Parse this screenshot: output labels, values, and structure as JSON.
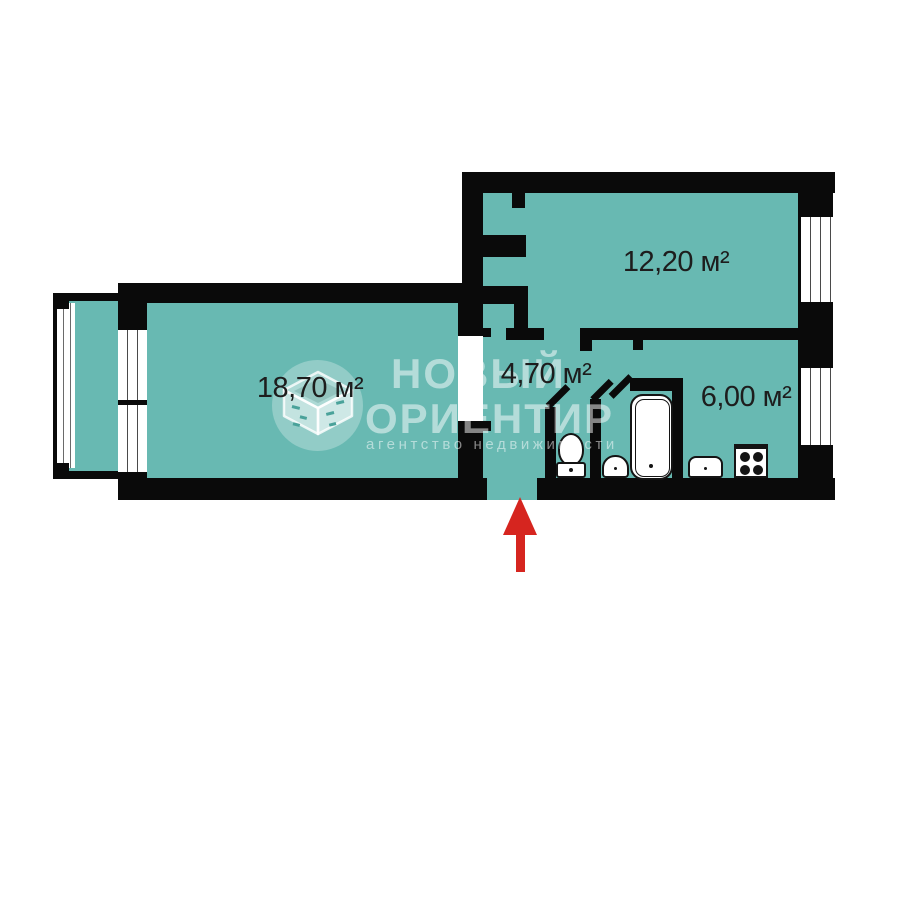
{
  "colors": {
    "background": "#ffffff",
    "room_fill": "#68b9b2",
    "wall": "#0a0a0a",
    "window_fill": "#ffffff",
    "fixture_fill": "#ffffff",
    "fixture_line": "#141414",
    "watermark": "rgba(255,255,255,0.5)",
    "watermark_circle": "rgba(255,255,255,0.28)",
    "label_text": "#1d1d1d",
    "entrance_arrow": "#d6251f"
  },
  "plan": {
    "type": "apartment-floor-plan",
    "rooms": [
      {
        "id": "living-room",
        "area_label": "18,70 м²"
      },
      {
        "id": "hallway",
        "area_label": "4,70 м²"
      },
      {
        "id": "bedroom",
        "area_label": "12,20 м²"
      },
      {
        "id": "kitchen",
        "area_label": "6,00 м²"
      }
    ],
    "fixtures": [
      "toilet",
      "wash-basin",
      "bathtub",
      "kitchen-sink",
      "stove"
    ],
    "features": [
      "balcony-with-glazing",
      "built-in-closet",
      "entrance-arrow"
    ]
  },
  "watermark": {
    "line1": "НОВЫЙ",
    "line2": "ОРИЕНТИР",
    "subtitle": "агентство недвижимости",
    "icon": "open-box-cube-logo"
  }
}
